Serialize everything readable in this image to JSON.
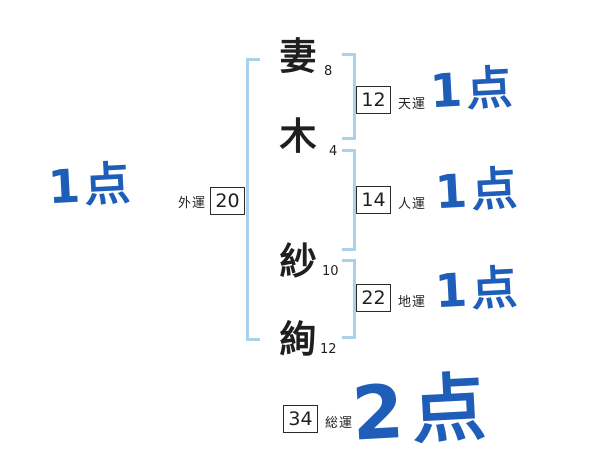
{
  "name_chars": [
    {
      "char": "妻",
      "strokes": "8"
    },
    {
      "char": "木",
      "strokes": "4"
    },
    {
      "char": "紗",
      "strokes": "10"
    },
    {
      "char": "絢",
      "strokes": "12"
    }
  ],
  "fortunes": {
    "gaiun": {
      "label": "外運",
      "value": "20",
      "score": "1点"
    },
    "tenun": {
      "label": "天運",
      "value": "12",
      "score": "1点"
    },
    "jinun": {
      "label": "人運",
      "value": "14",
      "score": "1点"
    },
    "chiun": {
      "label": "地運",
      "value": "22",
      "score": "1点"
    },
    "souun": {
      "label": "総運",
      "value": "34",
      "score": "2点"
    }
  },
  "colors": {
    "bracket_blue": "#a9d2ea",
    "score_blue": "#1e5eb8",
    "ink": "#1f1f1f"
  }
}
